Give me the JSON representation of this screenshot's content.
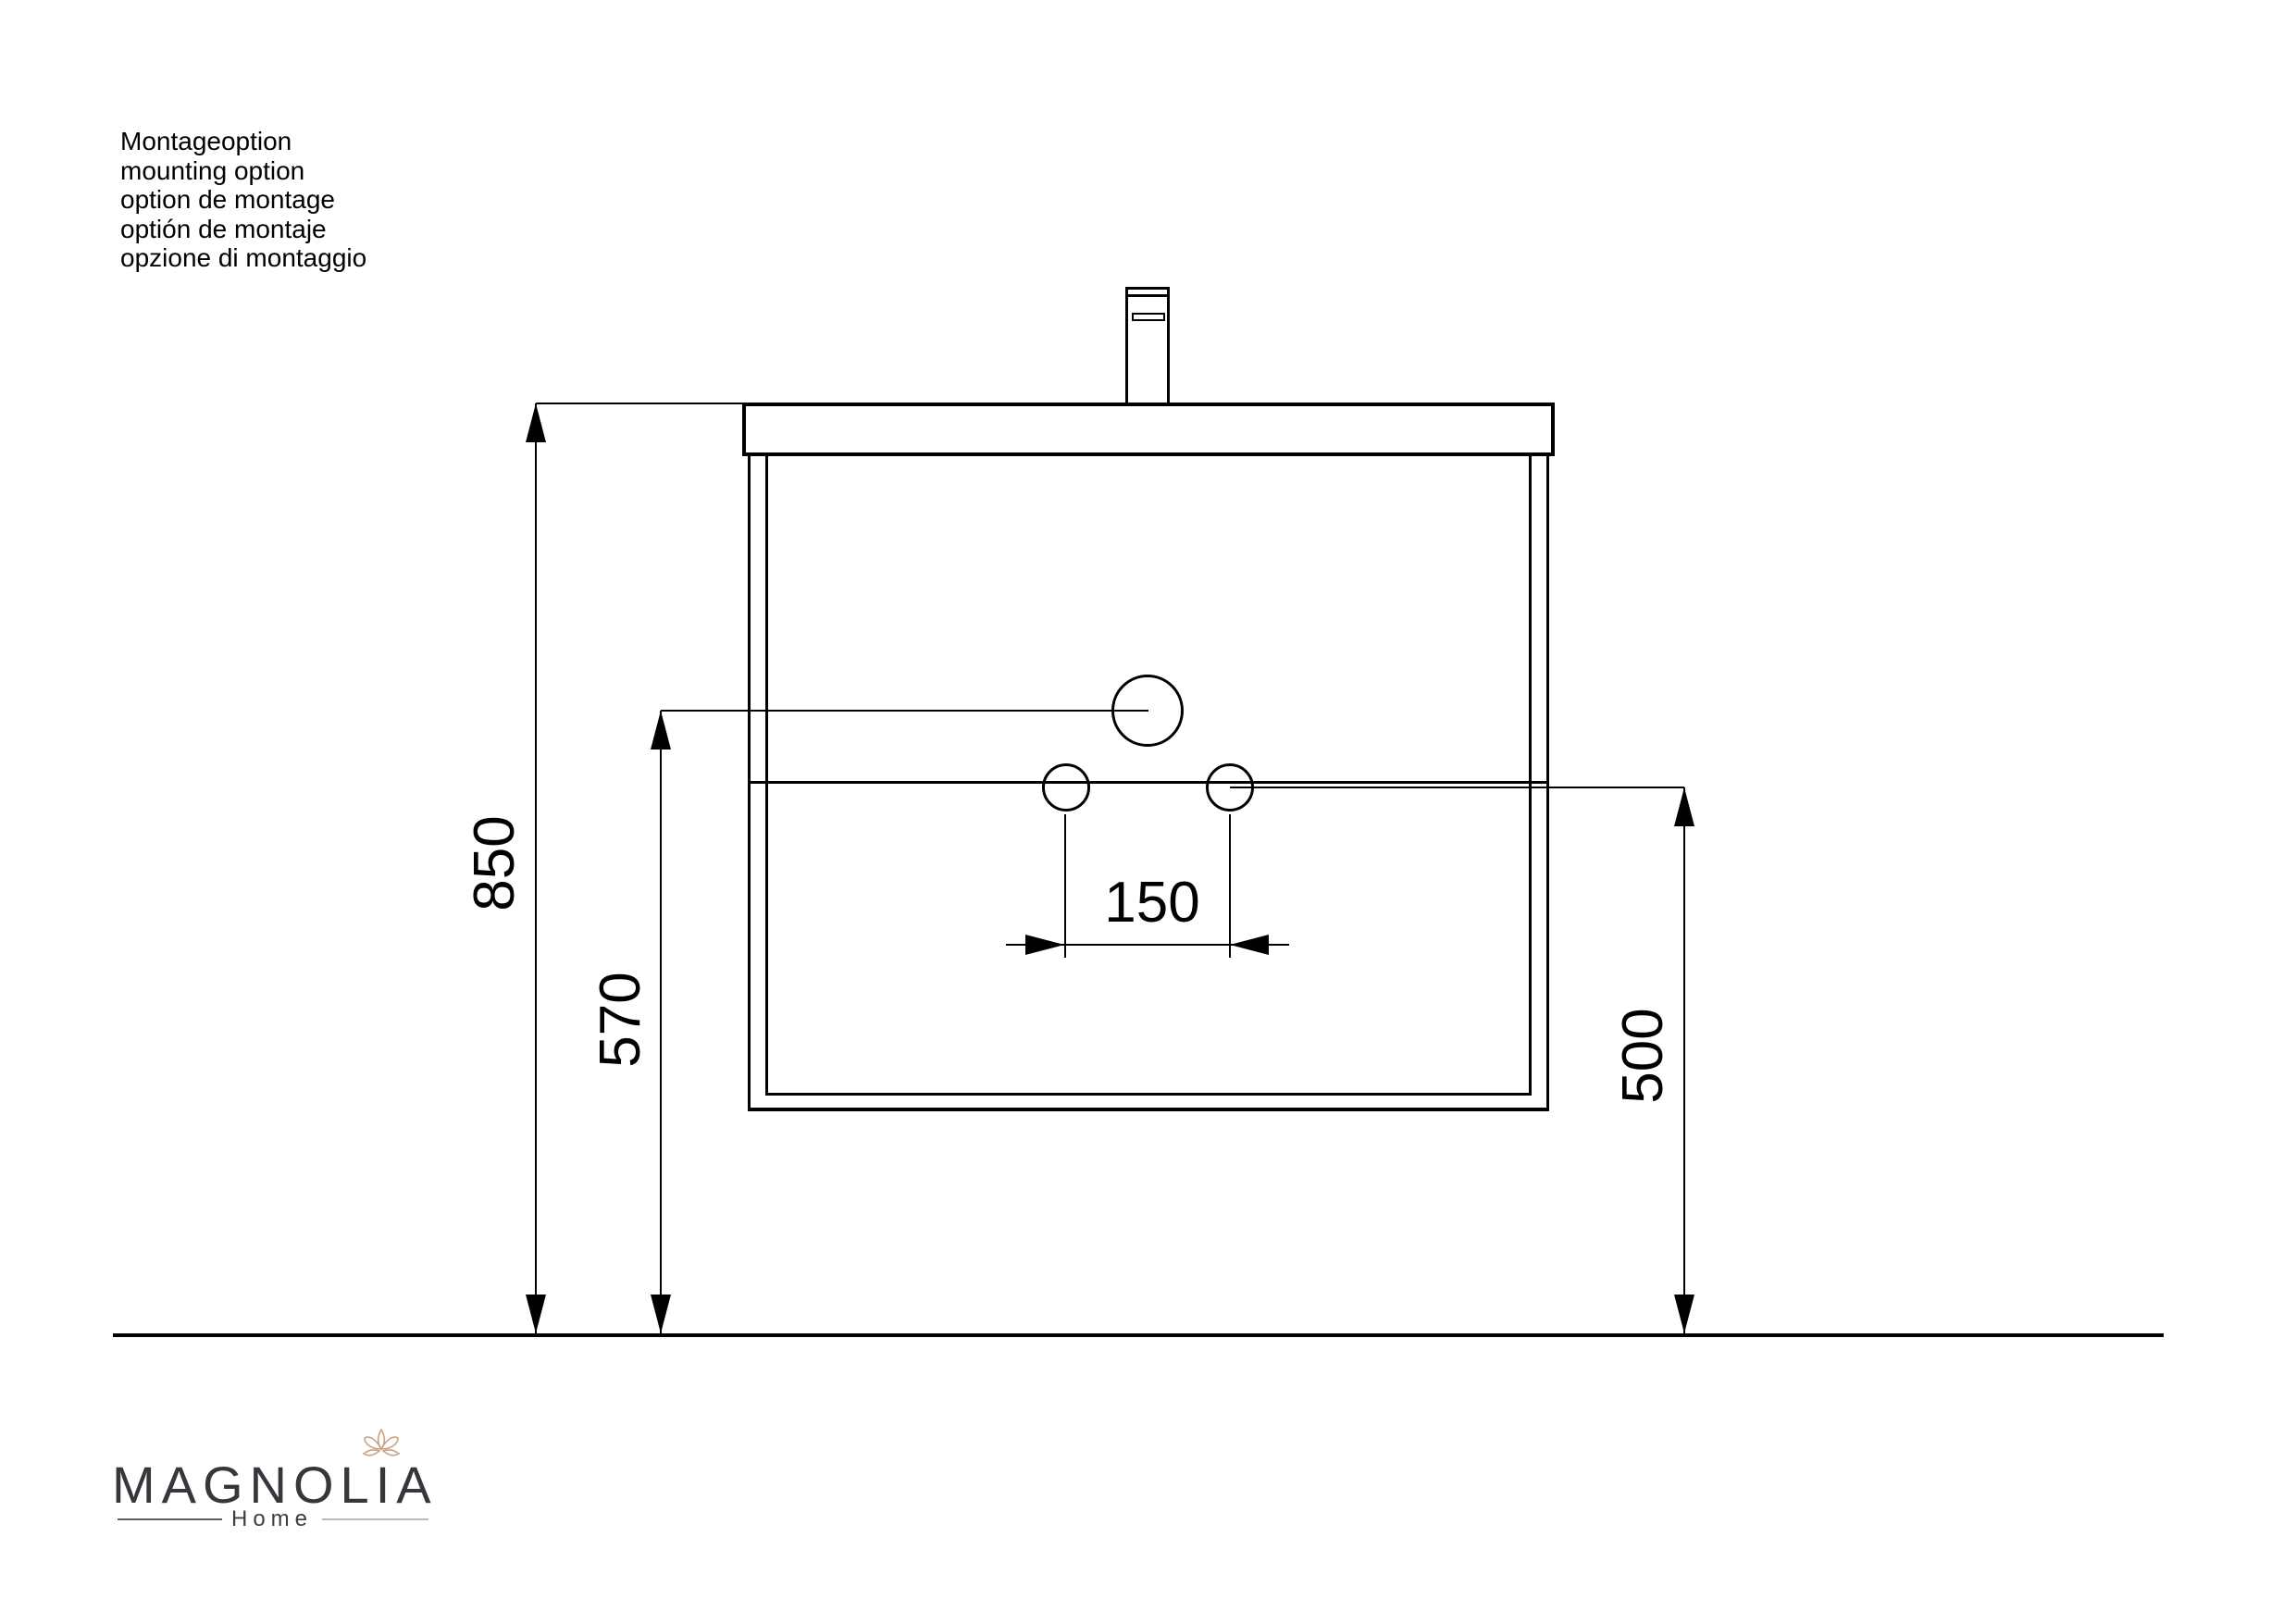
{
  "notes": {
    "lines": [
      "Montageoption",
      "mounting option",
      "option de montage",
      "optión de montaje",
      "opzione di montaggio"
    ]
  },
  "dimensions": {
    "overall_height": "850",
    "drain_height": "570",
    "hole_spacing": "150",
    "outlet_height": "500"
  },
  "logo": {
    "brand": "MAGNOLIA",
    "subtitle": "Home"
  },
  "colors": {
    "line": "#000000",
    "logo_text": "#36363c",
    "logo_flower": "#c9a287"
  }
}
